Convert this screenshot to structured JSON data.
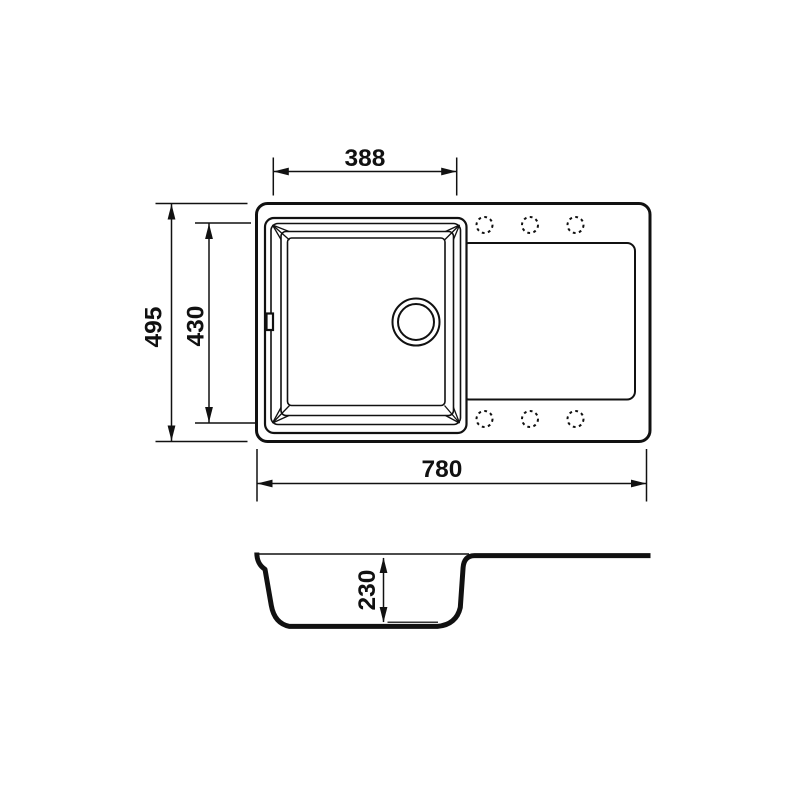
{
  "drawing": {
    "background_color": "#ffffff",
    "line_color": "#111111",
    "dimensions": {
      "bowl_width": {
        "label": "388"
      },
      "overall_depth": {
        "label": "495"
      },
      "bowl_front_back": {
        "label": "430"
      },
      "overall_width": {
        "label": "780"
      },
      "bowl_height": {
        "label": "230"
      }
    },
    "top_view": {
      "faucet_holes": {
        "count": 6,
        "rows": 2,
        "per_row": 3,
        "style": "dashed-circle"
      },
      "drain": {
        "style": "double-circle"
      },
      "overflow_slot": {
        "present": true
      }
    },
    "section_view": {
      "present": true
    }
  }
}
